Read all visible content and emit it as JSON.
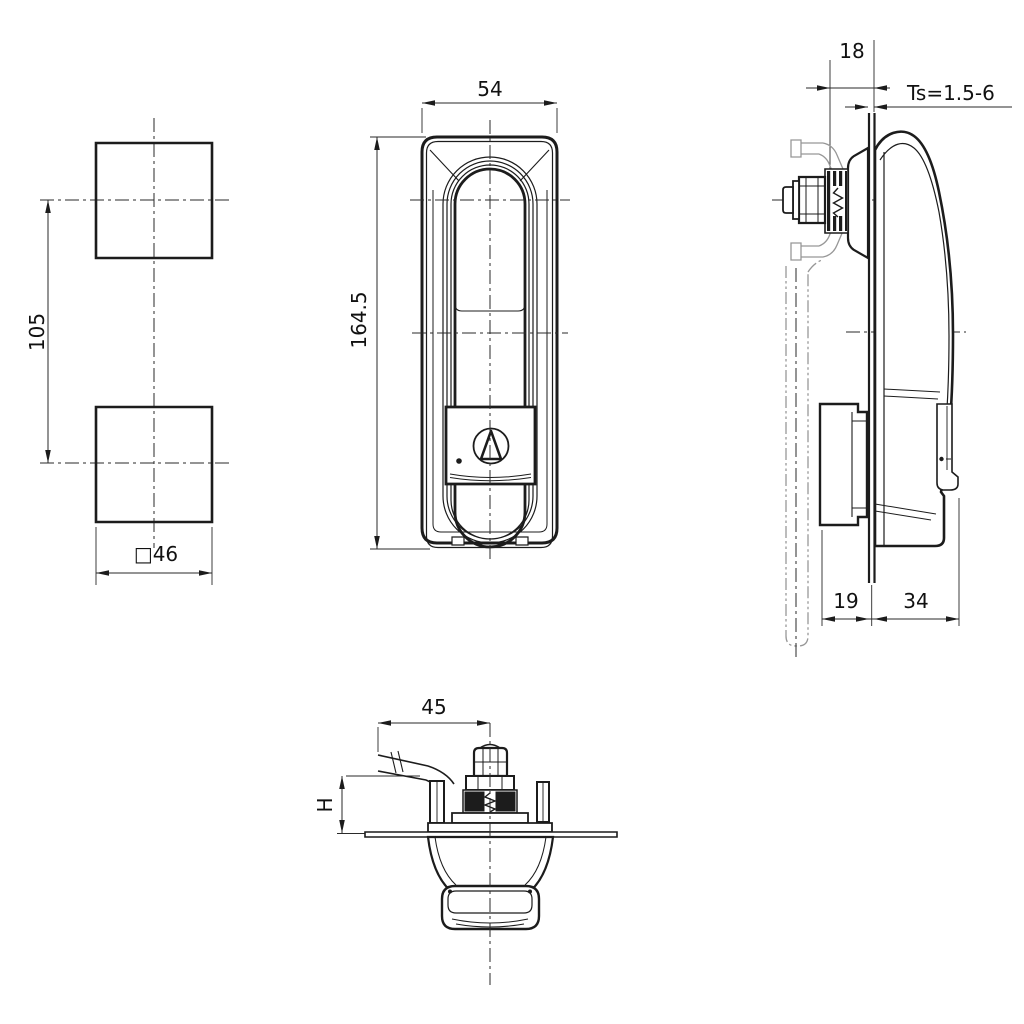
{
  "drawing": {
    "colors": {
      "background": "#ffffff",
      "line": "#1c1c1c",
      "phantom": "#979797"
    },
    "views": {
      "cutout_template": {
        "center_spacing": "105",
        "cutout_size": "□46"
      },
      "front_view": {
        "width": "54",
        "height": "164.5"
      },
      "side_view": {
        "grip_clearance": "18",
        "panel_thickness": "Ts=1.5-6",
        "depth_behind_panel": "19",
        "depth_in_front_of_panel": "34"
      },
      "bottom_view": {
        "cam_reach": "45",
        "cam_height": "H"
      }
    }
  }
}
